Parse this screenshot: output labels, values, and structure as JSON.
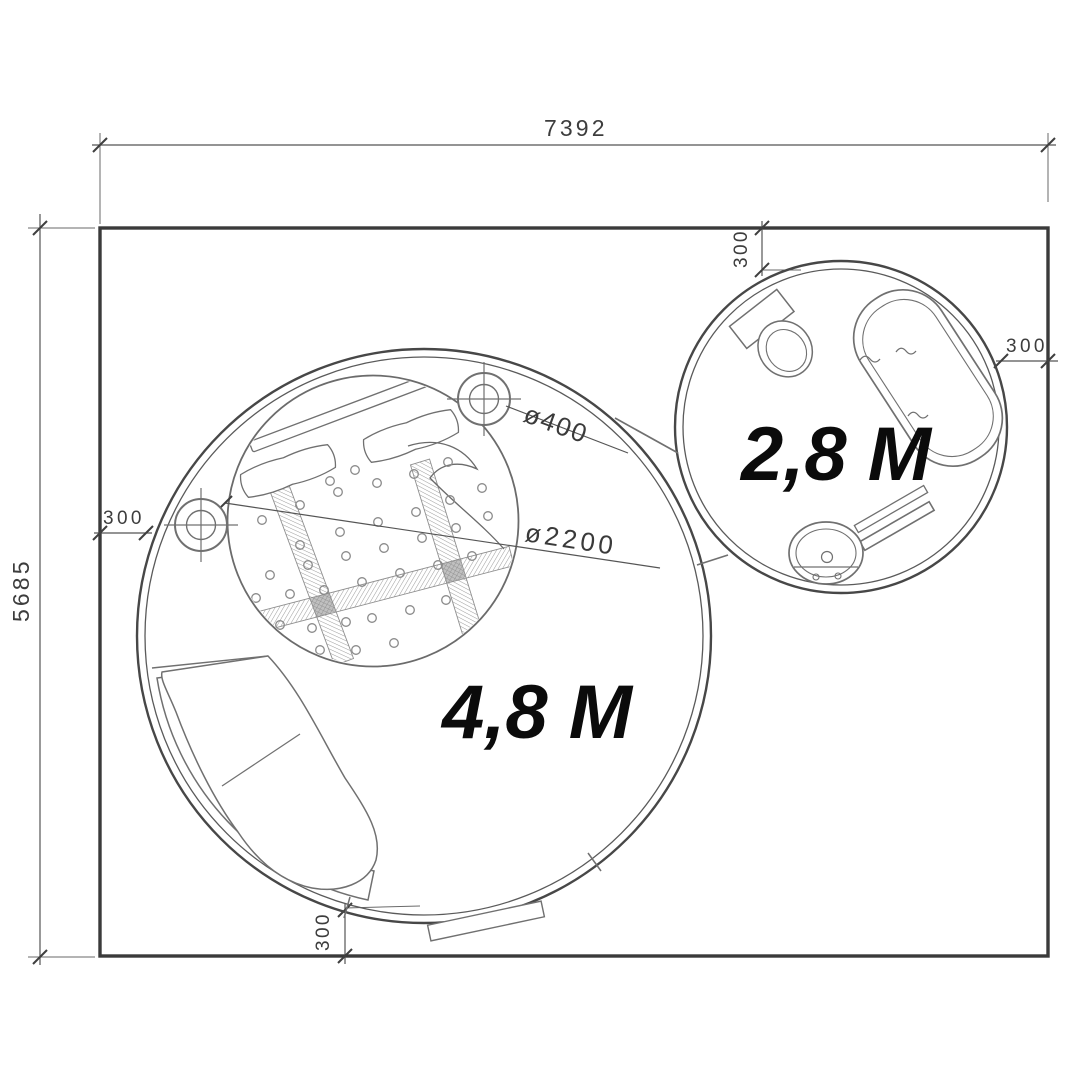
{
  "labels": {
    "width_total": "7392",
    "height_total": "5685",
    "offset_top": "300",
    "offset_right": "300",
    "offset_left": "300",
    "offset_bottom": "300",
    "column_diameter": "ø400",
    "bed_diameter": "ø2200"
  },
  "rooms": {
    "large_label": "4,8 M",
    "small_label": "2,8 M"
  },
  "colors": {
    "wall": "#3a3a3a",
    "dimension_line": "#555555",
    "furniture_line": "#707070",
    "room_label_text": "#0b0b0b",
    "dimension_text": "#3d3d3d",
    "background": "#ffffff"
  }
}
